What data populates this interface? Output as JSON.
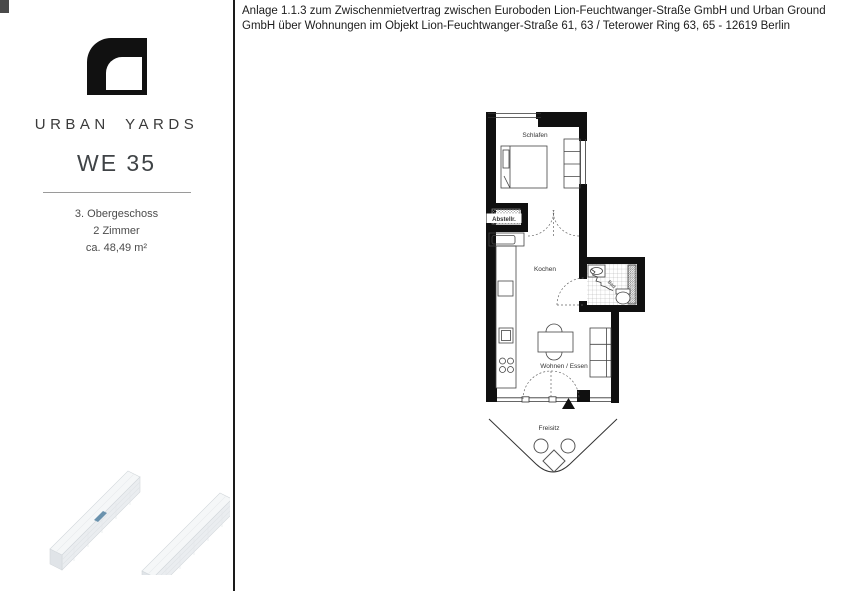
{
  "page": {
    "header": "Anlage 1.1.3 zum Zwischenmietvertrag zwischen Euroboden Lion-Feuchtwanger-Straße GmbH und Urban Ground GmbH über Wohnungen im Objekt Lion-Feuchtwanger-Straße 61, 63 / Teterower Ring 63, 65 - 12619 Berlin"
  },
  "sidebar": {
    "brand": "URBAN YARDS",
    "unit": "WE 35",
    "details": [
      "3. Obergeschoss",
      "2 Zimmer",
      "ca. 48,49 m²"
    ],
    "logo_color": "#111111",
    "unit_highlight_color": "#6a92ad"
  },
  "floorplan": {
    "rooms": {
      "bedroom": "Schlafen",
      "storage": "Abstellr.",
      "kitchen": "Kochen",
      "living": "Wohnen / Essen",
      "bath": "Bad",
      "terrace": "Freisitz"
    },
    "wall_color": "#101010"
  }
}
